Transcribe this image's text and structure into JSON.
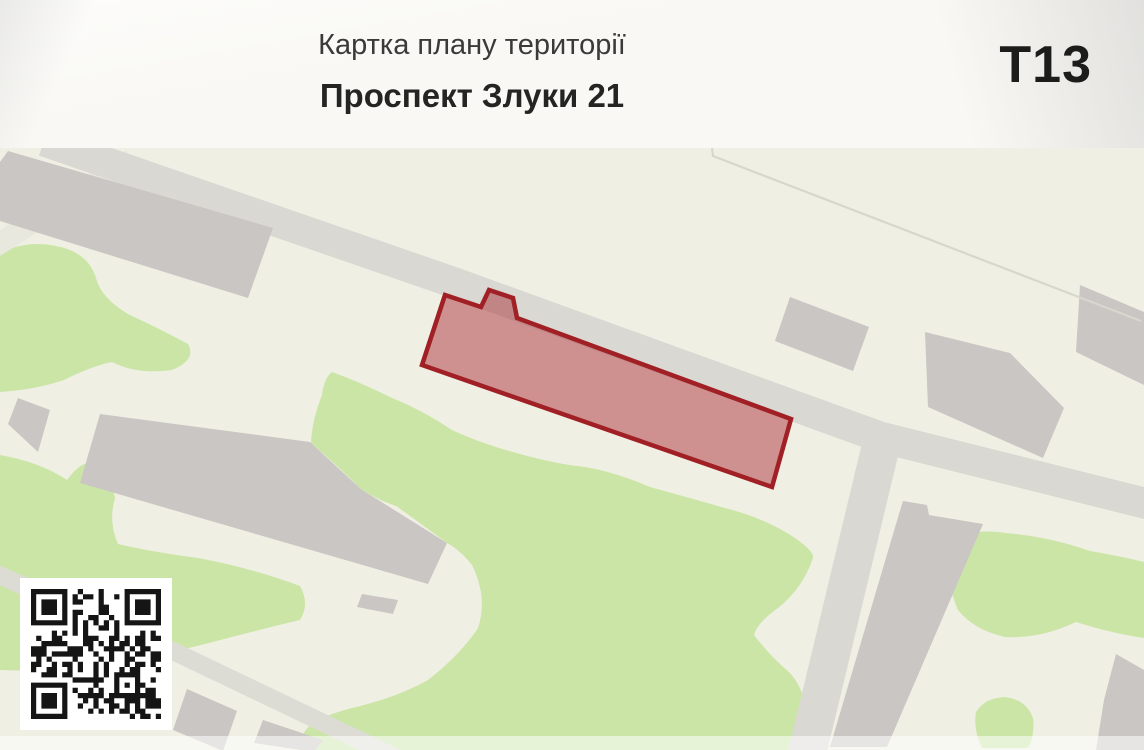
{
  "header": {
    "title": "Картка плану території",
    "subtitle": "Проспект Злуки 21",
    "sheet_code": "Т13"
  },
  "map": {
    "kind": "territory plan map",
    "highlighted_parcel": "Проспект Злуки 21",
    "qr_code_present": true
  },
  "colors": {
    "header_background": "#f9f8f4",
    "map_background": "#f0efe4",
    "green_area": "#cbe5a6",
    "building": "#c9c6c3",
    "road": "#d9d8d2",
    "footpath": "#dcdbd4",
    "minor_road": "#e9e8df",
    "boundary_line": "#d8d7cd",
    "parcel_fill": "#a6232b",
    "parcel_stroke": "#a02025",
    "qr_dark": "#151515",
    "qr_light": "#ffffff",
    "text_primary": "#242422",
    "text_secondary": "#3a3a38",
    "bottom_fade": "#ffffff"
  }
}
